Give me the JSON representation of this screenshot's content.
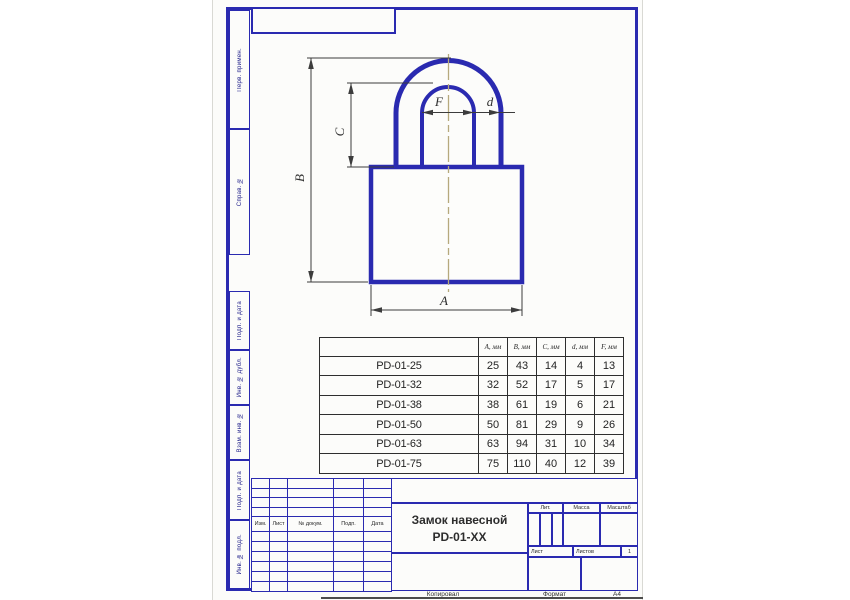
{
  "colors": {
    "blue": "#2a2ab0",
    "ink": "#333333",
    "centerline": "#b6a97d",
    "paper": "#fcfcfa"
  },
  "drawing": {
    "labels": {
      "A": "A",
      "B": "B",
      "C": "C",
      "F": "F",
      "d": "d"
    }
  },
  "left_stamps": {
    "items": [
      {
        "label": "Перв. примен."
      },
      {
        "label": "Справ. №"
      },
      {
        "label": "Подп. и дата"
      },
      {
        "label": "Инв. № дубл."
      },
      {
        "label": "Взам. инв. №"
      },
      {
        "label": "Подп. и дата"
      },
      {
        "label": "Инв. № подл."
      }
    ]
  },
  "size_table": {
    "headers": [
      "А, мм",
      "В, мм",
      "С, мм",
      "d, мм",
      "F, мм"
    ],
    "rows": [
      {
        "model": "PD-01-25",
        "values": [
          "25",
          "43",
          "14",
          "4",
          "13"
        ]
      },
      {
        "model": "PD-01-32",
        "values": [
          "32",
          "52",
          "17",
          "5",
          "17"
        ]
      },
      {
        "model": "PD-01-38",
        "values": [
          "38",
          "61",
          "19",
          "6",
          "21"
        ]
      },
      {
        "model": "PD-01-50",
        "values": [
          "50",
          "81",
          "29",
          "9",
          "26"
        ]
      },
      {
        "model": "PD-01-63",
        "values": [
          "63",
          "94",
          "31",
          "10",
          "34"
        ]
      },
      {
        "model": "PD-01-75",
        "values": [
          "75",
          "110",
          "40",
          "12",
          "39"
        ]
      }
    ]
  },
  "title_block": {
    "title_line1": "Замок навесной",
    "title_line2": "PD-01-XX",
    "rev_headers": [
      "Изм.",
      "Лист",
      "№ докум.",
      "Подп.",
      "Дата"
    ],
    "labels": {
      "lit": "Лит.",
      "mass": "Масса",
      "scale": "Масштаб",
      "sheet": "Лист",
      "sheets": "Листов",
      "sheets_value": "1"
    }
  },
  "footer": {
    "copied": "Копировал",
    "format_label": "Формат",
    "format_value": "А4"
  }
}
